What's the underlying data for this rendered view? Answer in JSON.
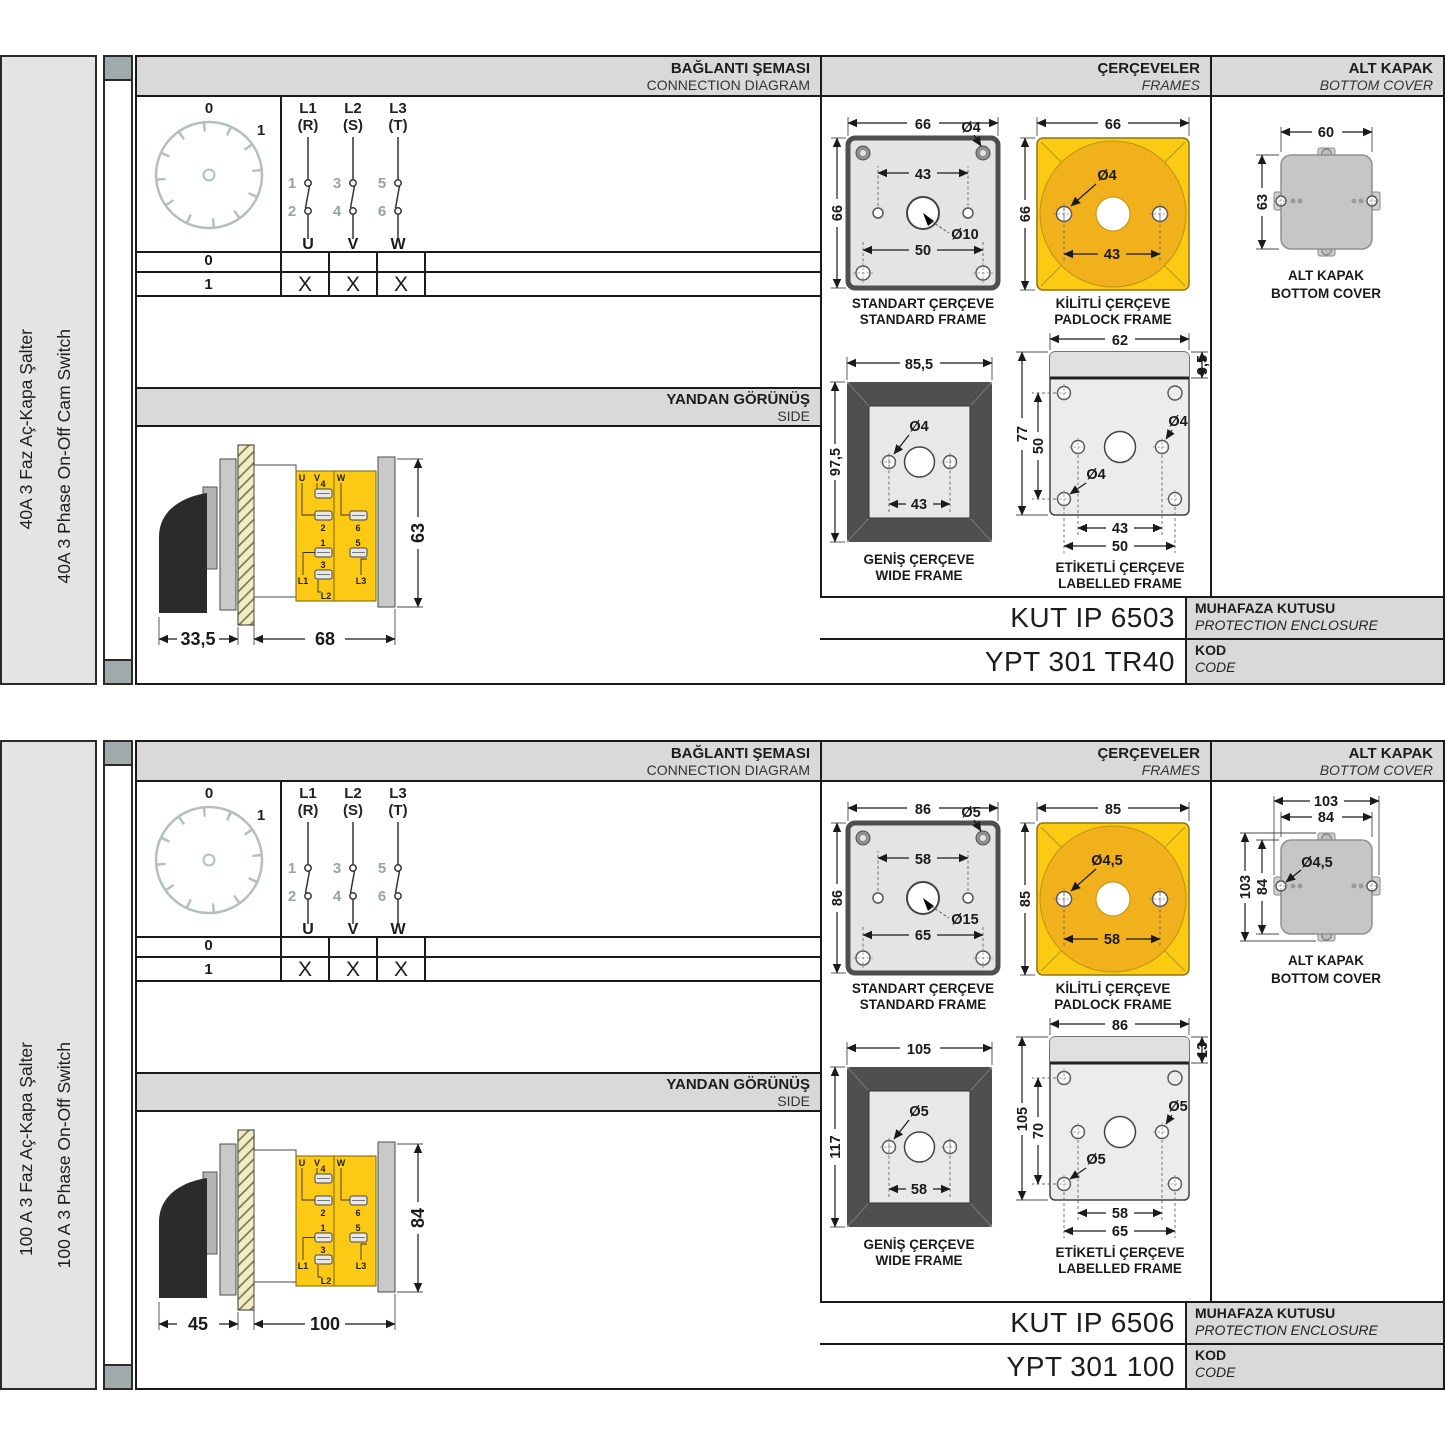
{
  "panels": [
    {
      "side_label_tr": "40A 3 Faz Aç-Kapa Şalter",
      "side_label_en": "40A 3 Phase On-Off Cam Switch",
      "headers": {
        "connection_tr": "BAĞLANTI ŞEMASI",
        "connection_en": "CONNECTION DIAGRAM",
        "frames_tr": "ÇERÇEVELER",
        "frames_en": "FRAMES",
        "cover_tr": "ALT KAPAK",
        "cover_en": "BOTTOM COVER",
        "side_tr": "YANDAN GÖRÜNÜŞ",
        "side_en": "SIDE"
      },
      "dial": {
        "pos0": "0",
        "pos1": "1"
      },
      "phases": {
        "l1": "L1",
        "l1p": "(R)",
        "l2": "L2",
        "l2p": "(S)",
        "l3": "L3",
        "l3p": "(T)",
        "c1": "1",
        "c2": "2",
        "c3": "3",
        "c4": "4",
        "c5": "5",
        "c6": "6",
        "u": "U",
        "v": "V",
        "w": "W"
      },
      "table": {
        "row0": "0",
        "row1": "1",
        "x1": "X",
        "x2": "X",
        "x3": "X"
      },
      "sideview": {
        "dim_handle": "33,5",
        "dim_body": "68",
        "dim_height": "63",
        "u": "U",
        "v": "V",
        "w": "W",
        "t1": "1",
        "t2": "2",
        "t3": "3",
        "t4": "4",
        "t5": "5",
        "t6": "6",
        "l1": "L1",
        "l2": "L2",
        "l3": "L3"
      },
      "standard_frame": {
        "cap_tr": "STANDART ÇERÇEVE",
        "cap_en": "STANDARD FRAME",
        "width": "66",
        "height": "66",
        "corner_hole": "Ø4",
        "hole_spacing": "43",
        "center_hole": "Ø10",
        "lower_spacing": "50"
      },
      "padlock_frame": {
        "cap_tr": "KİLİTLİ ÇERÇEVE",
        "cap_en": "PADLOCK FRAME",
        "width": "66",
        "height": "66",
        "hole": "Ø4",
        "hole_spacing": "43"
      },
      "wide_frame": {
        "cap_tr": "GENİŞ ÇERÇEVE",
        "cap_en": "WIDE FRAME",
        "width": "85,5",
        "height": "97,5",
        "hole": "Ø4",
        "hole_spacing": "43"
      },
      "labelled_frame": {
        "cap_tr": "ETİKETLİ ÇERÇEVE",
        "cap_en": "LABELLED FRAME",
        "width": "62",
        "strip": "9,5",
        "height": "77",
        "hole_v_spacing": "50",
        "hole_a": "Ø4",
        "hole_b": "Ø4",
        "dim_inner": "43",
        "dim_outer": "50"
      },
      "cover": {
        "cap_tr": "ALT KAPAK",
        "cap_en": "BOTTOM COVER",
        "top_body": "60",
        "left_body": "63"
      },
      "codes": {
        "enclosure_value": "KUT IP 6503",
        "enclosure_tr": "MUHAFAZA KUTUSU",
        "enclosure_en": "PROTECTION ENCLOSURE",
        "code_value": "YPT 301 TR40",
        "code_tr": "KOD",
        "code_en": "CODE"
      }
    },
    {
      "side_label_tr": "100 A 3 Faz Aç-Kapa Şalter",
      "side_label_en": "100 A 3 Phase On-Off Switch",
      "headers": {
        "connection_tr": "BAĞLANTI ŞEMASI",
        "connection_en": "CONNECTION DIAGRAM",
        "frames_tr": "ÇERÇEVELER",
        "frames_en": "FRAMES",
        "cover_tr": "ALT KAPAK",
        "cover_en": "BOTTOM COVER",
        "side_tr": "YANDAN GÖRÜNÜŞ",
        "side_en": "SIDE"
      },
      "dial": {
        "pos0": "0",
        "pos1": "1"
      },
      "phases": {
        "l1": "L1",
        "l1p": "(R)",
        "l2": "L2",
        "l2p": "(S)",
        "l3": "L3",
        "l3p": "(T)",
        "c1": "1",
        "c2": "2",
        "c3": "3",
        "c4": "4",
        "c5": "5",
        "c6": "6",
        "u": "U",
        "v": "V",
        "w": "W"
      },
      "table": {
        "row0": "0",
        "row1": "1",
        "x1": "X",
        "x2": "X",
        "x3": "X"
      },
      "sideview": {
        "dim_handle": "45",
        "dim_body": "100",
        "dim_height": "84",
        "u": "U",
        "v": "V",
        "w": "W",
        "t1": "1",
        "t2": "2",
        "t3": "3",
        "t4": "4",
        "t5": "5",
        "t6": "6",
        "l1": "L1",
        "l2": "L2",
        "l3": "L3"
      },
      "standard_frame": {
        "cap_tr": "STANDART ÇERÇEVE",
        "cap_en": "STANDARD FRAME",
        "width": "86",
        "height": "86",
        "corner_hole": "Ø5",
        "hole_spacing": "58",
        "center_hole": "Ø15",
        "lower_spacing": "65"
      },
      "padlock_frame": {
        "cap_tr": "KİLİTLİ ÇERÇEVE",
        "cap_en": "PADLOCK FRAME",
        "width": "85",
        "height": "85",
        "hole": "Ø4,5",
        "hole_spacing": "58"
      },
      "wide_frame": {
        "cap_tr": "GENİŞ ÇERÇEVE",
        "cap_en": "WIDE FRAME",
        "width": "105",
        "height": "117",
        "hole": "Ø5",
        "hole_spacing": "58"
      },
      "labelled_frame": {
        "cap_tr": "ETİKETLİ ÇERÇEVE",
        "cap_en": "LABELLED FRAME",
        "width": "86",
        "strip": "13",
        "height": "105",
        "hole_v_spacing": "70",
        "hole_a": "Ø5",
        "hole_b": "Ø5",
        "dim_inner": "58",
        "dim_outer": "65"
      },
      "cover": {
        "cap_tr": "ALT KAPAK",
        "cap_en": "BOTTOM COVER",
        "top_body": "84",
        "left_body": "84",
        "top_flange": "103",
        "left_flange": "103",
        "hole": "Ø4,5"
      },
      "codes": {
        "enclosure_value": "KUT IP 6506",
        "enclosure_tr": "MUHAFAZA KUTUSU",
        "enclosure_en": "PROTECTION ENCLOSURE",
        "code_value": "YPT 301 100",
        "code_tr": "KOD",
        "code_en": "CODE"
      }
    }
  ]
}
